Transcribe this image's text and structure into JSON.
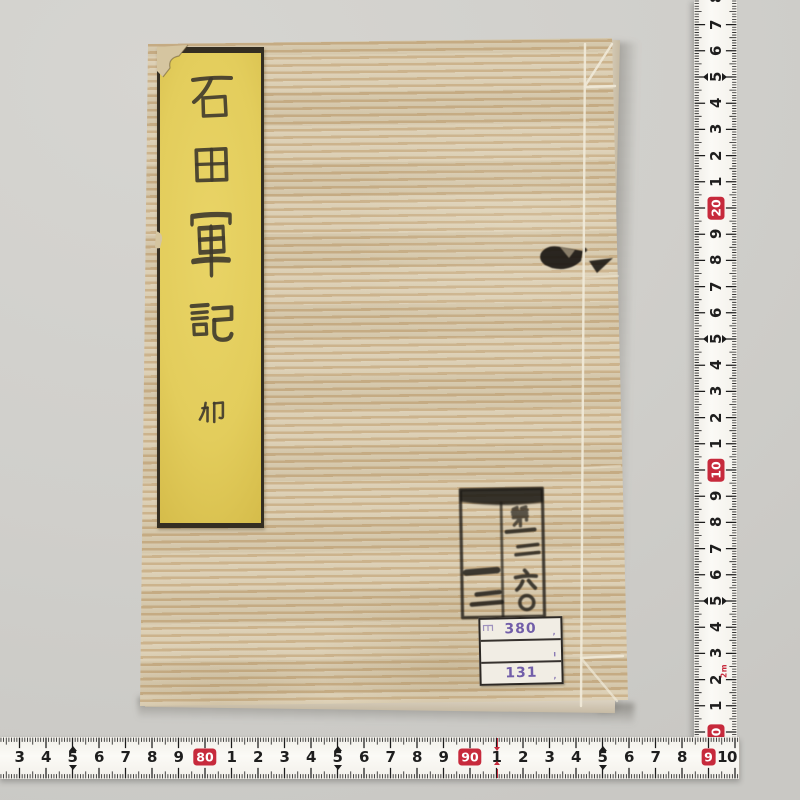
{
  "background_color": "#d1d0cc",
  "book": {
    "cover_base": "#d7c8a7",
    "cover_stripe_light": "#ddd0b6",
    "cover_stripe_dark": "#c9af87",
    "title_label": {
      "bg_color": "#e5cf5f",
      "title": "石田軍記",
      "chars": [
        "石",
        "田",
        "軍",
        "記"
      ],
      "volume_mark": "卯"
    },
    "stamp": {
      "right_column": "第一二六〇",
      "left_column": "一二",
      "ink_color": "#201d18"
    },
    "call_label": {
      "prefix": "ヨ",
      "row1": "380",
      "row2": "",
      "row3": "131",
      "text_color": "#6b57a6"
    }
  },
  "rulers": {
    "tape_color": "#f8f6f1",
    "tick_color": "#1c1c1c",
    "number_color": "#1e1e1e",
    "red": "#c72a3c",
    "vertical": {
      "labels_bottom_to_top": [
        "0",
        "1",
        "2",
        "3",
        "4",
        "5",
        "6",
        "7",
        "8",
        "9",
        "10",
        "1",
        "2",
        "3",
        "4",
        "5",
        "6",
        "7",
        "8",
        "9",
        "20",
        "1",
        "2",
        "3",
        "4",
        "5",
        "6",
        "7",
        "8"
      ],
      "red_labels": [
        0,
        10,
        20
      ],
      "arrow_labels": [
        5,
        15,
        25
      ],
      "meter_note": "2m",
      "meter_note_at": 2
    },
    "horizontal": {
      "labels_left_to_right": [
        "2",
        "3",
        "4",
        "5",
        "6",
        "7",
        "8",
        "9",
        "80",
        "1",
        "2",
        "3",
        "4",
        "5",
        "6",
        "7",
        "8",
        "9",
        "90",
        "1",
        "2",
        "3",
        "4",
        "5",
        "6",
        "7",
        "8",
        "9",
        "10"
      ],
      "red_labels": [
        8,
        18,
        27
      ],
      "arrow_labels": [
        3,
        13,
        23
      ],
      "red_mark_at": 19
    }
  }
}
